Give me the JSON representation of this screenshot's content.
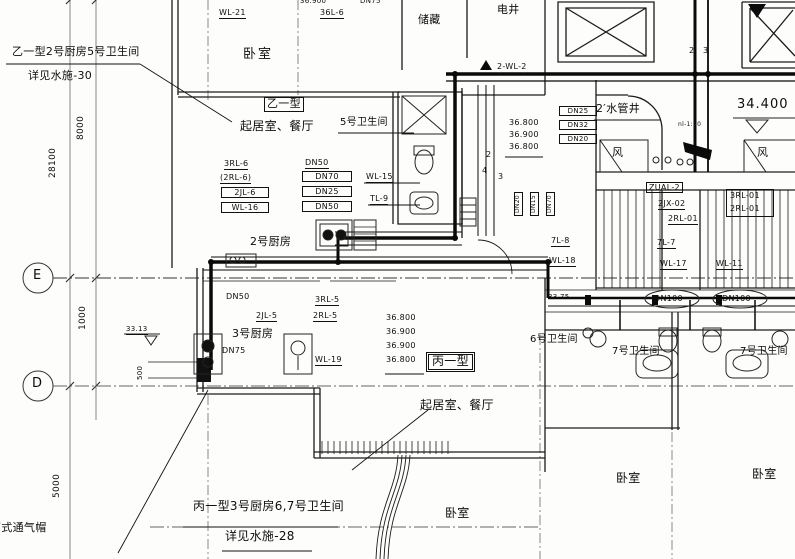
{
  "notes": {
    "tl1": "乙一型2号厨房5号卫生间",
    "tl2": "详见水施-30",
    "bn1": "丙一型3号厨房6,7号卫生间",
    "bn2": "详见水施-28",
    "vent": "筒式通气帽"
  },
  "grid": {
    "e": "E",
    "d": "D"
  },
  "dims": {
    "d28100": "28100",
    "d8000": "8000",
    "d1000": "1000",
    "d5000": "5000",
    "d500": "500"
  },
  "rooms": {
    "bedroom_top": "卧室",
    "storage": "储藏",
    "elec_shaft": "电井",
    "unit_b": "乙一型",
    "living_b": "起居室、餐厅",
    "bath5": "5号卫生间",
    "kitchen2": "2号厨房",
    "kitchen3": "3号厨房",
    "unit_c": "丙一型",
    "living_c": "起居室、餐厅",
    "bath6": "6号卫生间",
    "bath7_left": "7号卫生间",
    "bath7_right": "7号卫生间",
    "bedroom_c": "卧室",
    "bedroom_left": "卧室",
    "bedroom_right": "卧室",
    "water_shaft": "2′水管井",
    "fan_left": "风",
    "fan_right": "风"
  },
  "risers": {
    "wl21": "WL-21",
    "l36": "36L-6",
    "rl36": "3RL-6",
    "rl26": "(2RL-6)",
    "jl26": "2JL-6",
    "wl16": "WL-16",
    "wl15": "WL-15",
    "tl9": "TL-9",
    "m2wl2": "2-WL-2",
    "zual2": "ZUAL-2",
    "jx202": "2JX-02",
    "rl201a": "2RL-01",
    "rl301": "3RL-01",
    "rl201b": "2RL-01",
    "l78": "7L-8",
    "wl18": "WL-18",
    "l77": "7L-7",
    "wl17": "WL-17",
    "wl11": "WL-11",
    "jl25": "2JL-5",
    "rl35": "3RL-5",
    "rl25": "2RL-5",
    "wl19": "WL-19"
  },
  "pipe_nums": {
    "n2": "2",
    "n3": "3",
    "r2": "2",
    "r4": "4",
    "r3": "3"
  },
  "dn": {
    "dn50_top": "DN50",
    "dn70": "DN70",
    "dn25_mid": "DN25",
    "dn50_bot": "DN50",
    "dn25_shaft": "DN25",
    "dn32_shaft": "DN32",
    "dn20_shaft": "DN20",
    "dn20_v": "DN20",
    "dn15_v": "DN15",
    "dn70_v": "DN70",
    "dn50_k3": "DN50",
    "dn75_k3": "DN75",
    "dn75_top": "DN75",
    "dn100_left": "DN100",
    "dn100_right": "DN100"
  },
  "elev": {
    "e34400": "34.400",
    "stack_shaft": [
      "36.800",
      "36.900",
      "36.800"
    ],
    "stack_k3": [
      "36.800",
      "36.900",
      "36.900",
      "36.800"
    ],
    "e3313": "33.13",
    "e3375": "33.75",
    "e36900_top": "36.900",
    "scale_note": "nl-1:50"
  }
}
